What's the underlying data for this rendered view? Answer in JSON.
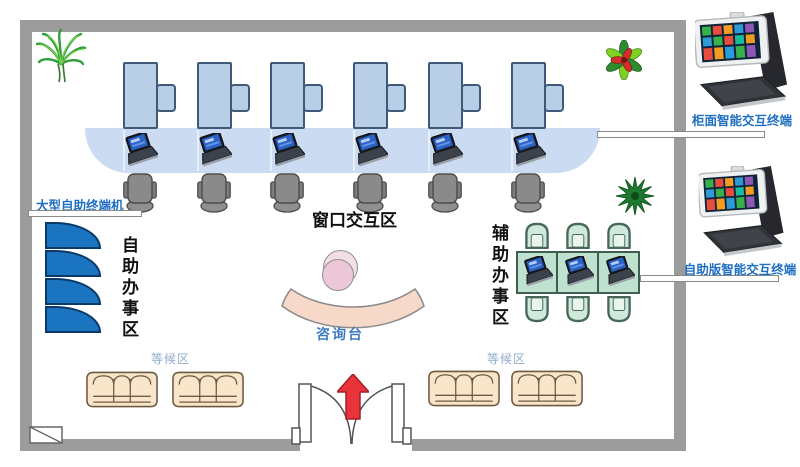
{
  "labels": {
    "large_self_terminal": "大型自助终端机",
    "window_interaction_zone": "窗口交互区",
    "self_service_zone": "自助办事区",
    "assist_service_zone": "辅助办事区",
    "consult_desk": "咨询台",
    "waiting_area_left": "等候区",
    "waiting_area_right": "等候区",
    "counter_terminal": "柜面智能交互终端",
    "self_version_terminal": "自助版智能交互终端"
  },
  "colors": {
    "wall_gray": "#9c9c9c",
    "desk_blue": "#b9cfe8",
    "counter_blue": "#cbdcf2",
    "kiosk_blue": "#1b74c0",
    "label_blue": "#1f6fc0",
    "waiting_label_blue": "#8fabcf",
    "zone_label_black": "#111111",
    "sofa_beige": "#f9e6ca",
    "assist_green": "#bfe2d0",
    "consult_peach": "#f7d9ca",
    "person_pink": "#ebc7d7",
    "entry_arrow_red": "#e8333a"
  },
  "counts": {
    "window_stations": 6,
    "window_laptops": 6,
    "window_chairs": 6,
    "self_service_kiosks": 4,
    "assist_tables": 3,
    "assist_laptops": 3,
    "assist_chairs": 6,
    "waiting_sofas": 4,
    "smart_terminals": 2
  }
}
